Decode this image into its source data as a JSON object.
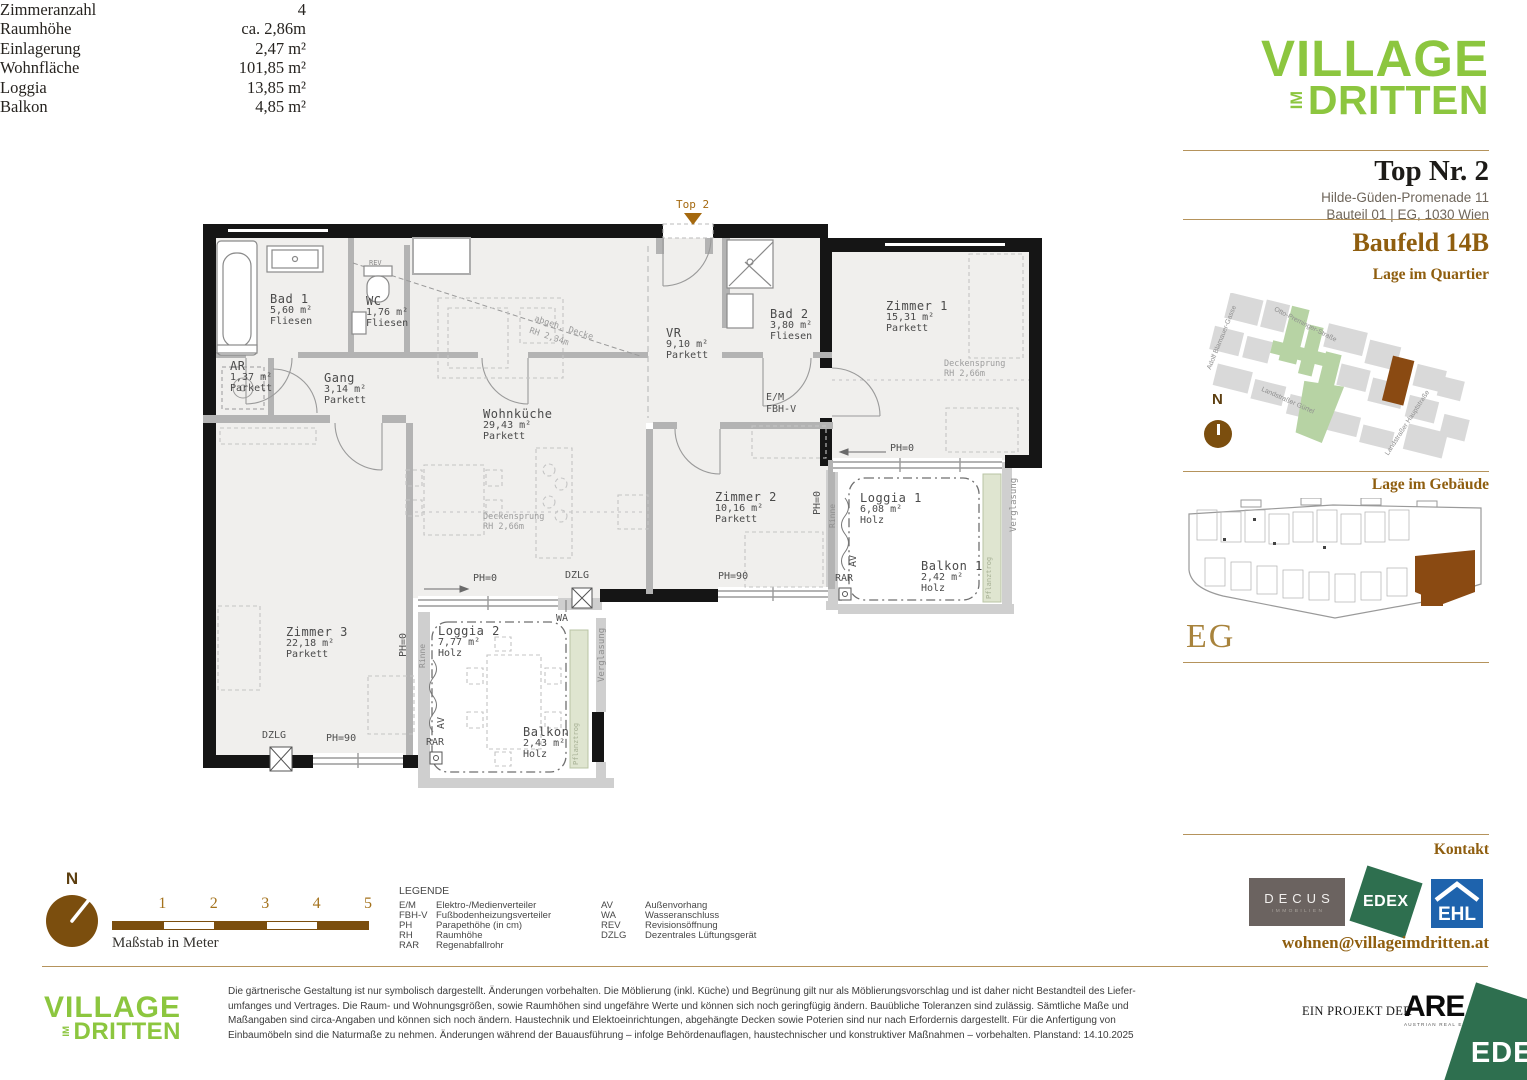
{
  "brand": {
    "logo_top": "VILLAGE",
    "logo_im": "IM",
    "logo_bottom": "DRITTEN",
    "green": "#8cc63f"
  },
  "header": {
    "unit_title": "Top Nr. 2",
    "address_line1": "Hilde-Güden-Promenade 11",
    "address_line2": "Bauteil 01 | EG, 1030 Wien",
    "baufeld": "Baufeld 14B",
    "quartier_heading": "Lage im Quartier",
    "gebaeude_heading": "Lage im Gebäude",
    "floor_label": "EG"
  },
  "quartier_map": {
    "north_label": "N",
    "streets": [
      {
        "text": "Adolf Blamauer-Gasse",
        "x": 1206,
        "y": 368,
        "r": -68
      },
      {
        "text": "Otto-Preminger-Straße",
        "x": 1276,
        "y": 306,
        "r": 27
      },
      {
        "text": "Landstraßer Gürtel",
        "x": 1263,
        "y": 386,
        "r": 24
      },
      {
        "text": "Landstraßer Hauptstraße",
        "x": 1384,
        "y": 453,
        "r": -57
      }
    ]
  },
  "stats": {
    "rows": [
      {
        "label": "Zimmeranzahl",
        "value": "4"
      },
      {
        "label": "Raumhöhe",
        "value": "ca. 2,86m"
      },
      {
        "label": "Einlagerung",
        "value": "2,47 m²"
      },
      {
        "label": "Wohnfläche",
        "value": "101,85 m²"
      },
      {
        "label": "Loggia",
        "value": "13,85 m²"
      },
      {
        "label": "Balkon",
        "value": "4,85 m²"
      }
    ]
  },
  "kontakt": {
    "heading": "Kontakt",
    "email": "wohnen@villageimdritten.at",
    "decus_name": "DECUS",
    "decus_sub": "IMMOBILIEN",
    "edex": "EDEX",
    "ehl": "EHL"
  },
  "scalebar": {
    "north_label": "N",
    "ticks": [
      "1",
      "2",
      "3",
      "4",
      "5"
    ],
    "caption": "Maßstab in Meter"
  },
  "legend": {
    "title": "LEGENDE",
    "col1": [
      [
        "E/M",
        "Elektro-/Medienverteiler"
      ],
      [
        "FBH-V",
        "Fußbodenheizungsverteiler"
      ],
      [
        "PH",
        "Parapethöhe (in cm)"
      ],
      [
        "RH",
        "Raumhöhe"
      ],
      [
        "RAR",
        "Regenabfallrohr"
      ]
    ],
    "col2": [
      [
        "AV",
        "Außenvorhang"
      ],
      [
        "WA",
        "Wasseranschluss"
      ],
      [
        "REV",
        "Revisionsöffnung"
      ],
      [
        "DZLG",
        "Dezentrales Lüftungsgerät"
      ]
    ]
  },
  "disclaimer": {
    "lines": [
      "Die gärtnerische Gestaltung ist nur symbolisch dargestellt. Änderungen vorbehalten. Die Möblierung (inkl. Küche) und Begrünung gilt nur als Möblierungsvorschlag und ist daher nicht Bestandteil des Liefer-",
      "umfanges und Vertrages. Die Raum- und Wohnungsgrößen, sowie Raumhöhen sind ungefähre Werte und können sich noch geringfügig ändern. Bauübliche Toleranzen sind zulässig. Sämtliche Maße und",
      "Maßangaben sind circa-Angaben und können sich noch ändern. Haustechnik und Elektoeinrichtungen, abgehängte Decken sowie Poterien sind nur nach Erfordernis dargestellt. Für die Anfertigung von",
      "Einbaumöbeln sind die Naturmaße zu nehmen. Änderungen während der Bauausführung – infolge Behördenauflagen, haustechnischer und konstruktiver Maßnahmen – vorbehalten. Planstand: 14.10.2025"
    ]
  },
  "footer": {
    "project_prefix": "EIN PROJEKT DER",
    "are": "ARE",
    "are_sub": "AUSTRIAN REAL ESTATE",
    "edex": "EDEX"
  },
  "floorplan": {
    "rooms": [
      {
        "lines": [
          "Bad 1",
          "5,60 m²",
          "Fliesen"
        ],
        "x": 270,
        "y": 293
      },
      {
        "lines": [
          "WC",
          "1,76 m²",
          "Fliesen"
        ],
        "x": 366,
        "y": 295
      },
      {
        "lines": [
          "AR",
          "1,37 m²",
          "Parkett"
        ],
        "x": 230,
        "y": 360
      },
      {
        "lines": [
          "Gang",
          "3,14 m²",
          "Parkett"
        ],
        "x": 324,
        "y": 372
      },
      {
        "lines": [
          "VR",
          "9,10 m²",
          "Parkett"
        ],
        "x": 666,
        "y": 327
      },
      {
        "lines": [
          "Bad 2",
          "3,80 m²",
          "Fliesen"
        ],
        "x": 770,
        "y": 308
      },
      {
        "lines": [
          "Zimmer 1",
          "15,31 m²",
          "Parkett"
        ],
        "x": 886,
        "y": 300
      },
      {
        "lines": [
          "Wohnküche",
          "29,43 m²",
          "Parkett"
        ],
        "x": 483,
        "y": 408
      },
      {
        "lines": [
          "Zimmer 2",
          "10,16 m²",
          "Parkett"
        ],
        "x": 715,
        "y": 491
      },
      {
        "lines": [
          "Zimmer 3",
          "22,18 m²",
          "Parkett"
        ],
        "x": 286,
        "y": 626
      },
      {
        "lines": [
          "Loggia 1",
          "6,08 m²",
          "Holz"
        ],
        "x": 860,
        "y": 492
      },
      {
        "lines": [
          "Balkon 1",
          "2,42 m²",
          "Holz"
        ],
        "x": 921,
        "y": 560
      },
      {
        "lines": [
          "Loggia 2",
          "7,77 m²",
          "Holz"
        ],
        "x": 438,
        "y": 625
      },
      {
        "lines": [
          "Balkon",
          "2,43 m²",
          "Holz"
        ],
        "x": 523,
        "y": 726
      }
    ],
    "annotations": [
      {
        "t": "Top 2",
        "x": 676,
        "y": 198,
        "s": 11,
        "c": "#a5690f"
      },
      {
        "t": "REV",
        "x": 369,
        "y": 259,
        "s": 7,
        "c": "#8a8a8a"
      },
      {
        "t": "E/M",
        "x": 766,
        "y": 392,
        "s": 10
      },
      {
        "t": "FBH-V",
        "x": 766,
        "y": 404,
        "s": 10
      },
      {
        "t": "PH=0",
        "x": 890,
        "y": 443,
        "s": 10
      },
      {
        "t": "PH=0",
        "x": 812,
        "y": 515,
        "s": 10,
        "r": -90
      },
      {
        "t": "Rinne",
        "x": 828,
        "y": 528,
        "s": 8,
        "r": -90,
        "c": "#8f8f8f"
      },
      {
        "t": "PH=0",
        "x": 473,
        "y": 573,
        "s": 10
      },
      {
        "t": "PH=90",
        "x": 718,
        "y": 571,
        "s": 10
      },
      {
        "t": "PH=90",
        "x": 326,
        "y": 733,
        "s": 10
      },
      {
        "t": "PH=0",
        "x": 398,
        "y": 657,
        "s": 10,
        "r": -90
      },
      {
        "t": "Rinne",
        "x": 418,
        "y": 668,
        "s": 8,
        "r": -90,
        "c": "#8f8f8f"
      },
      {
        "t": "DZLG",
        "x": 565,
        "y": 570,
        "s": 10
      },
      {
        "t": "DZLG",
        "x": 262,
        "y": 730,
        "s": 10
      },
      {
        "t": "RAR",
        "x": 835,
        "y": 573,
        "s": 10
      },
      {
        "t": "RAR",
        "x": 426,
        "y": 737,
        "s": 10
      },
      {
        "t": "AV",
        "x": 848,
        "y": 567,
        "s": 10,
        "r": -90
      },
      {
        "t": "AV",
        "x": 436,
        "y": 729,
        "s": 10,
        "r": -90
      },
      {
        "t": "WA",
        "x": 556,
        "y": 613,
        "s": 10
      },
      {
        "t": "Verglasung",
        "x": 1009,
        "y": 532,
        "s": 9,
        "r": -90,
        "c": "#8f8f8f"
      },
      {
        "t": "Verglasung",
        "x": 597,
        "y": 682,
        "s": 9,
        "r": -90,
        "c": "#8f8f8f"
      },
      {
        "t": "Pflanztrog",
        "x": 985,
        "y": 599,
        "s": 7,
        "r": -90,
        "c": "#a6b094"
      },
      {
        "t": "Pflanztrog",
        "x": 572,
        "y": 765,
        "s": 7,
        "r": -90,
        "c": "#a6b094"
      },
      {
        "t": "Deckensprung",
        "x": 944,
        "y": 359,
        "s": 8.5,
        "c": "#9c9c9c"
      },
      {
        "t": "RH 2,66m",
        "x": 944,
        "y": 369,
        "s": 8.5,
        "c": "#9c9c9c"
      },
      {
        "t": "Deckensprung",
        "x": 483,
        "y": 512,
        "s": 8.5,
        "c": "#9c9c9c"
      },
      {
        "t": "RH 2,66m",
        "x": 483,
        "y": 522,
        "s": 8.5,
        "c": "#9c9c9c"
      },
      {
        "t": "abgeh. Decke",
        "x": 536,
        "y": 314,
        "s": 8.5,
        "r": 18,
        "c": "#9c9c9c"
      },
      {
        "t": "RH 2,34m",
        "x": 531,
        "y": 326,
        "s": 8.5,
        "r": 18,
        "c": "#9c9c9c"
      }
    ]
  }
}
